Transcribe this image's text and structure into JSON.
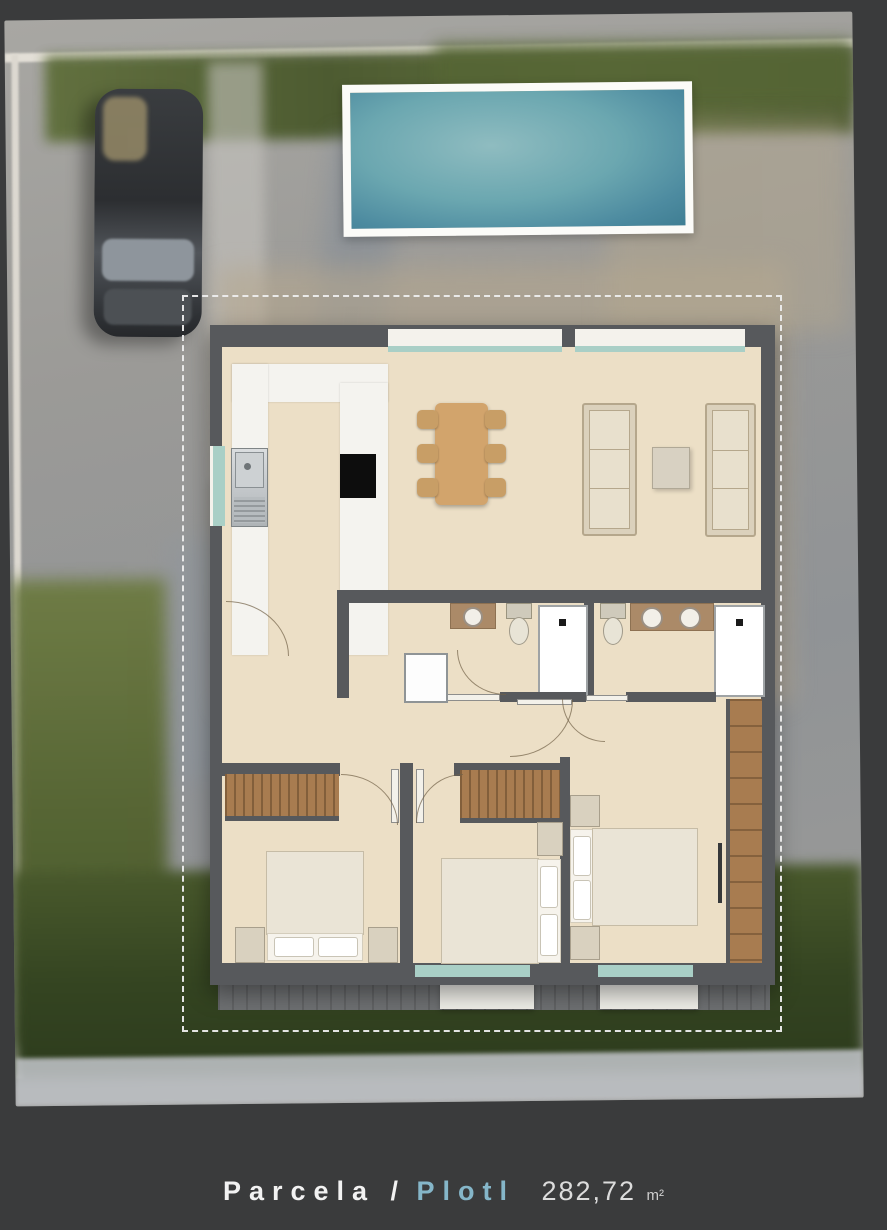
{
  "caption": {
    "label_primary": "Parcela /",
    "label_secondary": "Plotl",
    "area_value": "282,72",
    "area_unit": "m²"
  },
  "colors": {
    "page_bg": "#3a3b3c",
    "photo_paving": "#9a9996",
    "grass": "#5d6b38",
    "hedge": "#3c4e26",
    "pool_water": "#5f9dab",
    "pool_frame": "#fbfbf8",
    "wall": "#57595c",
    "floor": "#ecdfc6",
    "counter_white": "#f4f3ef",
    "wood_furniture": "#d2a46c",
    "wardrobe_wood": "#a87c50",
    "accent_blue": "#85b6c9",
    "text_white": "#f2f2f2",
    "boundary_white": "#eeeeee",
    "window_teal": "#a9cfc6",
    "deck_gray": "#6e7072",
    "car_body": "#303234"
  },
  "scene": {
    "type": "aerial-site-photo-with-floor-plan-overlay",
    "features": [
      "parked-car",
      "swimming-pool",
      "dashed-plot-boundary",
      "house-floor-plan",
      "kitchen",
      "dining-table-six-chairs",
      "two-sofas-coffee-table",
      "two-bathrooms",
      "three-bedrooms",
      "wardrobes",
      "garden-hedge",
      "rear-terrace"
    ]
  }
}
